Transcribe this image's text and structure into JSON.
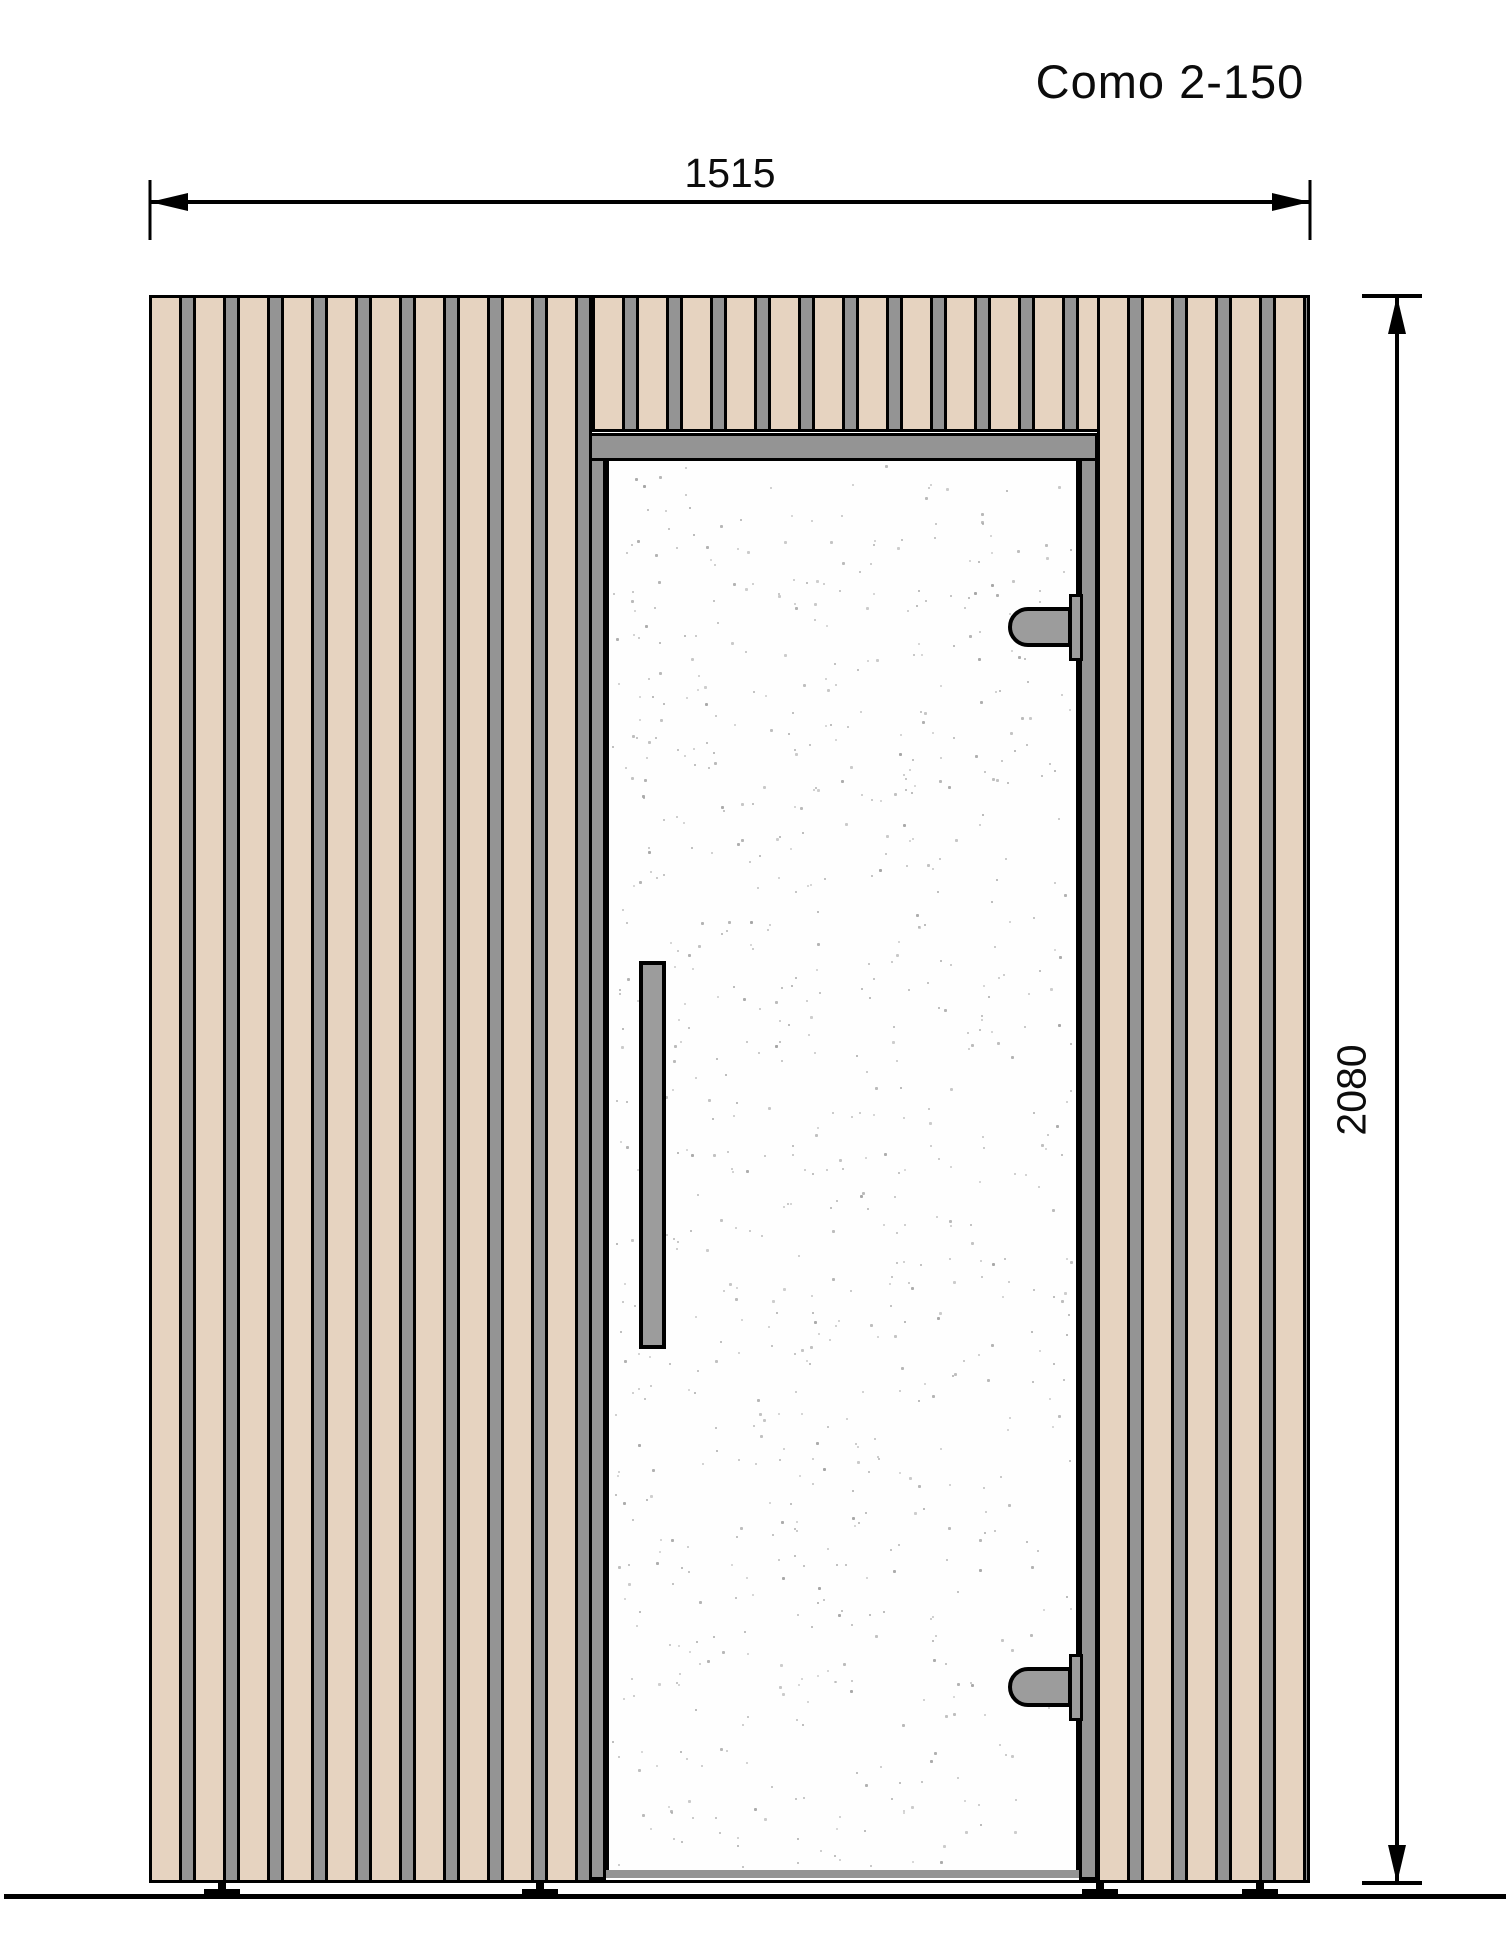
{
  "title": "Como 2-150",
  "dimensions": {
    "width_label": "1515",
    "height_label": "2080"
  },
  "drawing": {
    "view": "front elevation",
    "subject": "sauna cabin with vertical wood slat cladding and full-height glass door",
    "door": {
      "handle": "vertical bar handle on left side of glass",
      "hinges": "two hinges on right edge of glass",
      "glass": "speckled safety glass"
    },
    "feet_count": 4
  },
  "colors": {
    "wood": "#e6d3c0",
    "slat_gray": "#949494",
    "frame_gray": "#949494",
    "hardware_gray": "#9c9c9c",
    "outline": "#000000",
    "glass_speckle": "#a6a6a6",
    "background": "#ffffff"
  }
}
